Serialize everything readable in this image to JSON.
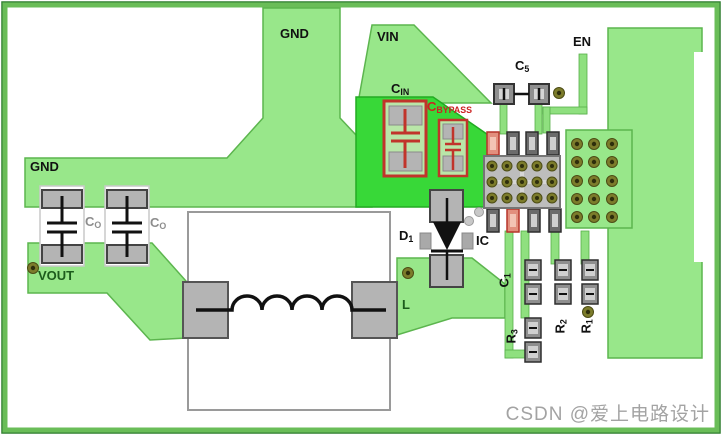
{
  "board": {
    "type": "pcb-layout-diagram",
    "labels": {
      "gnd_top": "GND",
      "gnd_left": "GND",
      "vin": "VIN",
      "en": "EN",
      "vout": "VOUT",
      "ic": "IC",
      "inductor": "L"
    },
    "components": {
      "c5": {
        "base": "C",
        "sub": "5"
      },
      "cin": {
        "base": "C",
        "sub": "IN"
      },
      "cbypass": {
        "base": "C",
        "sub": "BYPASS"
      },
      "co1": {
        "base": "C",
        "sub": "O"
      },
      "co2": {
        "base": "C",
        "sub": "O"
      },
      "d1": {
        "base": "D",
        "sub": "1"
      },
      "c1": {
        "base": "C",
        "sub": "1"
      },
      "r3": {
        "base": "R",
        "sub": "3"
      },
      "r2": {
        "base": "R",
        "sub": "2"
      },
      "r1": {
        "base": "R",
        "sub": "1"
      }
    },
    "colors": {
      "copper_light": "#98e78a",
      "copper_bright": "#38d838",
      "board_frame": "#6abd58",
      "component_outline_red": "#c1342b",
      "via_olive": "#7c7c2b",
      "pad_gray": "#b4b4b4",
      "label_red": "#cc2222",
      "label_gray": "#8d8d8d"
    },
    "watermark": "CSDN @爱上电路设计"
  }
}
